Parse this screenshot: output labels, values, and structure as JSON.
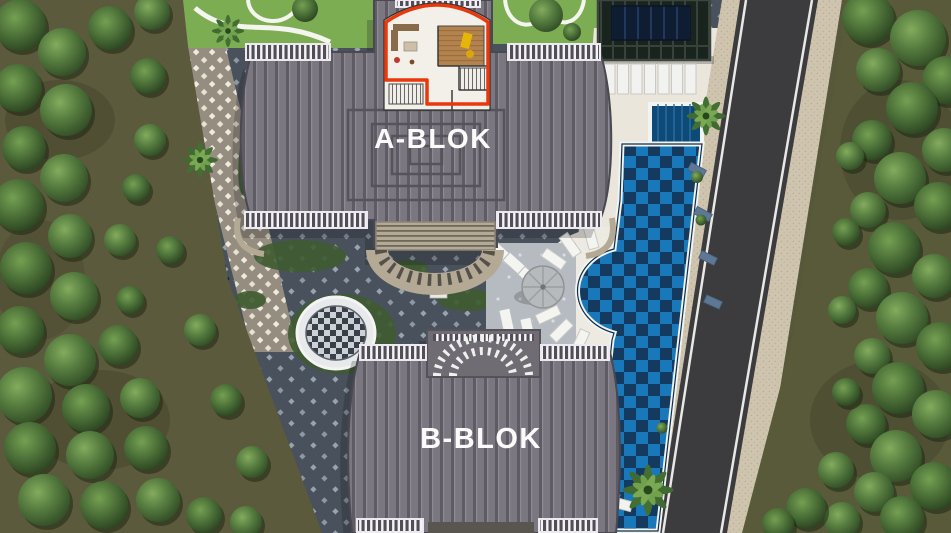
{
  "blocks": [
    {
      "label": "A-BLOK"
    },
    {
      "label": "B-BLOK"
    }
  ],
  "selected_unit": {
    "outline_color": "#e8380d"
  },
  "palette": {
    "accent_red": "#e8380d",
    "pool_light_blue": "#1878ba",
    "pool_dark_blue": "#153a60",
    "roof_gray": "#787680",
    "road_asphalt": "#3c3c3f",
    "sidewalk_beige": "#cfc5af",
    "courtyard_paver": "#49525c",
    "tree_green": "#567d3f",
    "lawn_green": "#7dad52",
    "deck_white": "#eae6dc",
    "railing_white": "#f4f4f6",
    "label_white": "#fbfbfb"
  }
}
